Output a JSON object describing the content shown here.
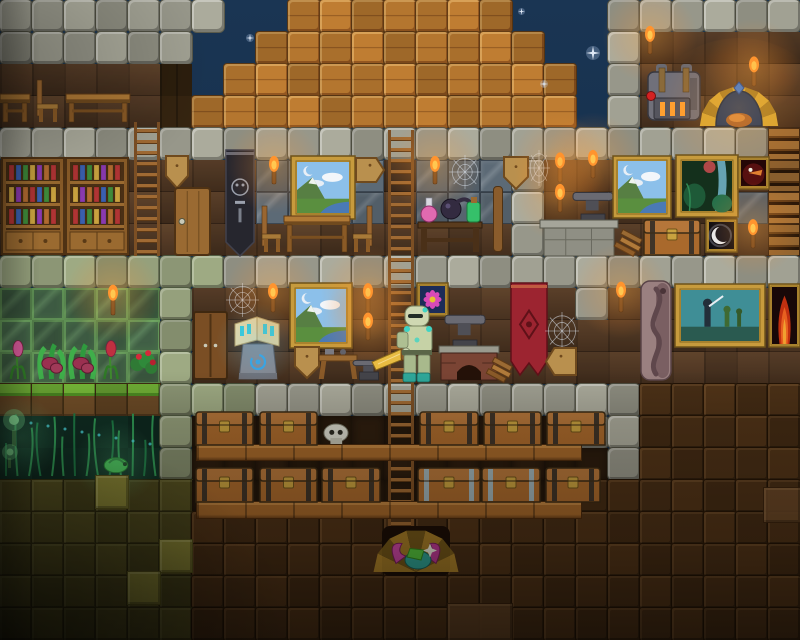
{
  "meta": {
    "scene": "terraria-style-sandbox-house-night",
    "width": 800,
    "height": 640,
    "tile_size": 32
  },
  "palette": {
    "sky_top": "#1a3553",
    "sky_bottom": "#101f35",
    "star": "#dfe8f5",
    "stone": "#a1a193",
    "mossy_stone": "#95a07c",
    "wood_block": "#b4762f",
    "plank_wall": "#503723",
    "glass_wall": "#57646f",
    "greenhouse_glass": "#3d5a42",
    "dirt_block": "#4c3117",
    "dirt_wall": "#2b1c0e",
    "mud": "#514d20",
    "mud_light": "#8e8b38",
    "jungle_wall": "#0f2f24",
    "grass": "#6fae35",
    "torch_flame": "#ff9a30",
    "gold_frame": "#c79b3d",
    "chest_wood": "#a9692c",
    "iron_trim": "#9fb3b8",
    "banner_red": "#9c2430",
    "banner_black": "#26262e",
    "player_armor": "#c6d2a6",
    "player_accent": "#3fd4c4",
    "sword_gold": "#e8bc42"
  },
  "tilemap": {
    "legend": {
      "S": "stone-brick",
      "M": "mossy-stone",
      "W": "wood-beam-block",
      "w": "plank-wall",
      "v": "dark-plank-wall",
      "G": "glass-wall",
      "g": "greenhouse-glass",
      "K": "sky",
      "d": "dirt-wall",
      "D": "dirt-block",
      "J": "jungle-wall",
      "m": "mud-block",
      "L": "grass-block",
      "R": "platform-shelf"
    },
    "solid": [
      "S",
      "M",
      "W",
      "D",
      "m",
      "L",
      "R"
    ],
    "rows": [
      "SSSSSSSKKWWWWWWWKKKSSSSSS",
      "SSSSSSKKWWWWWWWWWKKSwwwww",
      "wwwwwvKWWWWWWWWWWWKSwwwww",
      "wwwwwvWWWWWWWWWWWWKSwwwww",
      "SSSSSSSSSSSSSSSSSSSSSSSSR",
      "wwwwwwwwGGGGwGGGSwwwwwwwR",
      "wwwwwwwwGGGGwGGGSwwwwwwGR",
      "wwwwwwwwwwwwwwwwSwwwwwwwR",
      "MMMMMMMSSSSSSSSSSSSSSSSSS",
      "gggggMwwwwwwwwwwwwSwwwwww",
      "gggggMwwwwwwwwwwwwwwwwwww",
      "gggggMwwwwwwwwwwwwwwwwwww",
      "LLLLLMMMSSSSSSSSSSSSDDDDD",
      "JJJJJMddddddddddddSSDDDDD",
      "JJJJJMdddddddddddddSDDDDD",
      "mmmmmmddddddddddddDDDDDDD",
      "mmmmmmDDDDDDDDDDDDDDDDDDD",
      "mmmmmmDDDDDDDDDDDDDDDDDDD",
      "mmmmmmDDDDDDDDDDDDDDDDDDD",
      "mmmmmmDDDDDDDDDDDDDDDDDDD"
    ]
  },
  "entities": [
    {
      "name": "star-1",
      "type": "star",
      "x": 586,
      "y": 46,
      "w": 14,
      "h": 14,
      "i": false
    },
    {
      "name": "star-2",
      "type": "star",
      "x": 246,
      "y": 34,
      "w": 8,
      "h": 8,
      "i": false
    },
    {
      "name": "star-3",
      "type": "star",
      "x": 540,
      "y": 80,
      "w": 8,
      "h": 8,
      "i": false
    },
    {
      "name": "star-4",
      "type": "star",
      "x": 518,
      "y": 8,
      "w": 7,
      "h": 7,
      "i": false
    },
    {
      "name": "tavern-table-small",
      "type": "table",
      "x": 0,
      "y": 94,
      "w": 30,
      "h": 28,
      "i": true
    },
    {
      "name": "tavern-chair",
      "type": "chair",
      "x": 36,
      "y": 80,
      "w": 24,
      "h": 42,
      "i": true
    },
    {
      "name": "tavern-table",
      "type": "table",
      "x": 66,
      "y": 94,
      "w": 64,
      "h": 28,
      "i": true
    },
    {
      "name": "attic-torch",
      "type": "torch",
      "x": 642,
      "y": 26,
      "w": 16,
      "h": 28,
      "i": false
    },
    {
      "name": "wall-torch-right",
      "type": "torch",
      "x": 746,
      "y": 56,
      "w": 16,
      "h": 30,
      "i": false
    },
    {
      "name": "extractinator-machine",
      "type": "machine",
      "x": 646,
      "y": 64,
      "w": 56,
      "h": 60,
      "i": true
    },
    {
      "name": "hearth-food-shrine",
      "type": "foodshrine",
      "x": 710,
      "y": 86,
      "w": 58,
      "h": 40,
      "i": true
    },
    {
      "name": "ladder-left",
      "type": "ladder",
      "x": 134,
      "y": 122,
      "w": 26,
      "h": 134,
      "i": true
    },
    {
      "name": "ladder-main",
      "type": "ladder",
      "x": 388,
      "y": 130,
      "w": 26,
      "h": 402,
      "i": true
    },
    {
      "name": "bookshelf-left",
      "type": "bookshelf",
      "x": 2,
      "y": 158,
      "w": 62,
      "h": 96,
      "i": true
    },
    {
      "name": "bookshelf-right",
      "type": "bookshelf",
      "x": 66,
      "y": 158,
      "w": 62,
      "h": 96,
      "i": true
    },
    {
      "name": "sign-pennant-library",
      "type": "sign",
      "variant": "pennant",
      "x": 166,
      "y": 156,
      "w": 22,
      "h": 32,
      "i": true
    },
    {
      "name": "wooden-door",
      "type": "door",
      "x": 175,
      "y": 188,
      "w": 35,
      "h": 67,
      "i": true
    },
    {
      "name": "black-banner",
      "type": "banner",
      "variant": "black",
      "x": 226,
      "y": 150,
      "w": 28,
      "h": 106,
      "i": false
    },
    {
      "name": "torch-f2-1",
      "type": "torch",
      "x": 266,
      "y": 156,
      "w": 16,
      "h": 28,
      "i": false
    },
    {
      "name": "painting-mountain-f2",
      "type": "painting",
      "variant": "mountain",
      "x": 291,
      "y": 156,
      "w": 64,
      "h": 63,
      "i": false
    },
    {
      "name": "sign-arrow-right",
      "type": "sign",
      "variant": "arrowr",
      "x": 356,
      "y": 158,
      "w": 28,
      "h": 24,
      "i": true
    },
    {
      "name": "dining-chair-left",
      "type": "chair",
      "x": 261,
      "y": 206,
      "w": 22,
      "h": 46,
      "i": true
    },
    {
      "name": "dining-table",
      "type": "table",
      "x": 284,
      "y": 216,
      "w": 66,
      "h": 36,
      "i": true
    },
    {
      "name": "dining-chair-right",
      "type": "chair",
      "variant": "flip",
      "x": 351,
      "y": 206,
      "w": 22,
      "h": 46,
      "i": true
    },
    {
      "name": "torch-f2-2",
      "type": "torch",
      "x": 427,
      "y": 156,
      "w": 16,
      "h": 28,
      "i": false
    },
    {
      "name": "spider-web-f2",
      "type": "web",
      "x": 449,
      "y": 155,
      "w": 32,
      "h": 34,
      "i": false
    },
    {
      "name": "alchemy-table",
      "type": "potiontable",
      "x": 417,
      "y": 188,
      "w": 66,
      "h": 64,
      "i": true
    },
    {
      "name": "wood-beam-pole",
      "type": "pole",
      "x": 493,
      "y": 186,
      "w": 10,
      "h": 66,
      "i": false
    },
    {
      "name": "sign-pennant-2",
      "type": "sign",
      "variant": "pennant",
      "x": 504,
      "y": 157,
      "w": 24,
      "h": 32,
      "i": true
    },
    {
      "name": "spider-web-corner",
      "type": "web",
      "x": 528,
      "y": 150,
      "w": 22,
      "h": 36,
      "i": false
    },
    {
      "name": "torch-forge-1",
      "type": "torch",
      "x": 552,
      "y": 152,
      "w": 16,
      "h": 30,
      "i": false
    },
    {
      "name": "torch-forge-2",
      "type": "torch",
      "x": 585,
      "y": 150,
      "w": 16,
      "h": 28,
      "i": false
    },
    {
      "name": "torch-forge-3",
      "type": "torch",
      "x": 552,
      "y": 184,
      "w": 16,
      "h": 28,
      "i": false
    },
    {
      "name": "anvil-f2",
      "type": "anvil",
      "x": 573,
      "y": 186,
      "w": 40,
      "h": 36,
      "i": true
    },
    {
      "name": "stone-hearth",
      "type": "hearth",
      "x": 540,
      "y": 220,
      "w": 78,
      "h": 36,
      "i": false
    },
    {
      "name": "wood-debris",
      "type": "debris",
      "x": 619,
      "y": 226,
      "w": 24,
      "h": 28,
      "i": false
    },
    {
      "name": "storage-chest-f2",
      "type": "chest",
      "variant": "wood",
      "x": 644,
      "y": 220,
      "w": 56,
      "h": 35,
      "i": true
    },
    {
      "name": "painting-mountain-2",
      "type": "painting",
      "variant": "mountain",
      "x": 613,
      "y": 156,
      "w": 58,
      "h": 62,
      "i": false
    },
    {
      "name": "painting-jungle",
      "type": "painting",
      "variant": "jungle",
      "x": 676,
      "y": 155,
      "w": 62,
      "h": 62,
      "i": false
    },
    {
      "name": "painting-demon",
      "type": "painting",
      "variant": "demon",
      "x": 738,
      "y": 157,
      "w": 31,
      "h": 32,
      "i": false
    },
    {
      "name": "painting-moon",
      "type": "painting",
      "variant": "moon",
      "x": 706,
      "y": 219,
      "w": 31,
      "h": 33,
      "i": false
    },
    {
      "name": "torch-moon",
      "type": "torch",
      "x": 745,
      "y": 219,
      "w": 16,
      "h": 29,
      "i": false
    },
    {
      "name": "greenhouse-torch",
      "type": "torch",
      "x": 105,
      "y": 284,
      "w": 16,
      "h": 31,
      "i": false
    },
    {
      "name": "plant-tulip-1",
      "type": "plant",
      "variant": "tulip",
      "x": 6,
      "y": 342,
      "w": 24,
      "h": 37,
      "i": false
    },
    {
      "name": "plant-venus-1",
      "type": "plant",
      "variant": "venus",
      "x": 35,
      "y": 340,
      "w": 33,
      "h": 39,
      "i": false
    },
    {
      "name": "plant-venus-2",
      "type": "plant",
      "variant": "venus",
      "x": 66,
      "y": 340,
      "w": 33,
      "h": 39,
      "i": false
    },
    {
      "name": "plant-tulip-2",
      "type": "plant",
      "variant": "tulip2",
      "x": 100,
      "y": 342,
      "w": 22,
      "h": 37,
      "i": false
    },
    {
      "name": "plant-roses",
      "type": "plant",
      "variant": "rose",
      "x": 128,
      "y": 342,
      "w": 31,
      "h": 37,
      "i": false
    },
    {
      "name": "wooden-wardrobe",
      "type": "wardrobe",
      "x": 194,
      "y": 312,
      "w": 33,
      "h": 67,
      "i": true
    },
    {
      "name": "spider-web-f3",
      "type": "web",
      "x": 226,
      "y": 283,
      "w": 33,
      "h": 34,
      "i": false
    },
    {
      "name": "spell-book-altar",
      "type": "bookaltar",
      "x": 233,
      "y": 308,
      "w": 48,
      "h": 71,
      "i": true
    },
    {
      "name": "torch-f3-1",
      "type": "torch",
      "x": 265,
      "y": 283,
      "w": 16,
      "h": 29,
      "i": false
    },
    {
      "name": "painting-mountain-3",
      "type": "painting",
      "variant": "mountain",
      "x": 290,
      "y": 283,
      "w": 62,
      "h": 65,
      "i": false
    },
    {
      "name": "torch-f3-2",
      "type": "torch",
      "x": 360,
      "y": 283,
      "w": 16,
      "h": 29,
      "i": false
    },
    {
      "name": "torch-f3-3",
      "type": "torch",
      "x": 360,
      "y": 313,
      "w": 16,
      "h": 27,
      "i": false
    },
    {
      "name": "sign-shield",
      "type": "sign",
      "variant": "pennant",
      "x": 295,
      "y": 347,
      "w": 24,
      "h": 31,
      "i": true
    },
    {
      "name": "work-bench",
      "type": "workbench",
      "x": 319,
      "y": 349,
      "w": 38,
      "h": 30,
      "i": true
    },
    {
      "name": "anvil-small",
      "type": "anvil",
      "x": 353,
      "y": 356,
      "w": 32,
      "h": 24,
      "i": true
    },
    {
      "name": "painting-flower",
      "type": "painting",
      "variant": "flower",
      "x": 417,
      "y": 283,
      "w": 31,
      "h": 33,
      "i": false
    },
    {
      "name": "anvil-large",
      "type": "anvil",
      "x": 445,
      "y": 308,
      "w": 40,
      "h": 40,
      "i": true
    },
    {
      "name": "brick-hearth",
      "type": "hearthbrick",
      "x": 439,
      "y": 346,
      "w": 60,
      "h": 34,
      "i": false
    },
    {
      "name": "wood-slope",
      "type": "debris",
      "x": 491,
      "y": 354,
      "w": 22,
      "h": 26,
      "i": false
    },
    {
      "name": "red-banner",
      "type": "banner",
      "variant": "red",
      "x": 511,
      "y": 283,
      "w": 36,
      "h": 92,
      "i": false
    },
    {
      "name": "spider-web-f3-2",
      "type": "web",
      "x": 545,
      "y": 312,
      "w": 34,
      "h": 38,
      "i": false
    },
    {
      "name": "sign-arrow-left",
      "type": "sign",
      "variant": "arrowl",
      "x": 546,
      "y": 348,
      "w": 30,
      "h": 27,
      "i": true
    },
    {
      "name": "torch-f3-4",
      "type": "torch",
      "x": 612,
      "y": 281,
      "w": 18,
      "h": 31,
      "i": false
    },
    {
      "name": "carved-pillar",
      "type": "pillar",
      "x": 640,
      "y": 281,
      "w": 32,
      "h": 99,
      "i": false
    },
    {
      "name": "painting-battle",
      "type": "painting",
      "variant": "battle",
      "x": 675,
      "y": 284,
      "w": 90,
      "h": 63,
      "i": false
    },
    {
      "name": "painting-fire",
      "type": "painting",
      "variant": "fire",
      "x": 769,
      "y": 284,
      "w": 31,
      "h": 63,
      "i": false
    },
    {
      "name": "floor-plank-upper",
      "type": "floor",
      "x": 196,
      "y": 444,
      "w": 386,
      "h": 17,
      "i": false
    },
    {
      "name": "floor-plank-lower",
      "type": "floor",
      "x": 196,
      "y": 501,
      "w": 386,
      "h": 18,
      "i": false
    },
    {
      "name": "chest-r1-1",
      "type": "chest",
      "variant": "wood",
      "x": 196,
      "y": 412,
      "w": 57,
      "h": 33,
      "i": true
    },
    {
      "name": "chest-r1-2",
      "type": "chest",
      "variant": "wood",
      "x": 260,
      "y": 412,
      "w": 57,
      "h": 33,
      "i": true
    },
    {
      "name": "skull-item",
      "type": "skull",
      "x": 322,
      "y": 424,
      "w": 28,
      "h": 20,
      "i": false
    },
    {
      "name": "chest-r1-3",
      "type": "chest",
      "variant": "wood",
      "x": 420,
      "y": 412,
      "w": 58,
      "h": 33,
      "i": true
    },
    {
      "name": "chest-r1-4",
      "type": "chest",
      "variant": "wood",
      "x": 484,
      "y": 412,
      "w": 57,
      "h": 33,
      "i": true
    },
    {
      "name": "chest-r1-5",
      "type": "chest",
      "variant": "wood",
      "x": 547,
      "y": 412,
      "w": 58,
      "h": 33,
      "i": true
    },
    {
      "name": "chest-r2-1",
      "type": "chest",
      "variant": "wood",
      "x": 196,
      "y": 468,
      "w": 57,
      "h": 34,
      "i": true
    },
    {
      "name": "chest-r2-2",
      "type": "chest",
      "variant": "wood",
      "x": 260,
      "y": 468,
      "w": 57,
      "h": 34,
      "i": true
    },
    {
      "name": "chest-r2-3",
      "type": "chest",
      "variant": "wood",
      "x": 322,
      "y": 468,
      "w": 58,
      "h": 34,
      "i": true
    },
    {
      "name": "chest-r2-4",
      "type": "chest",
      "variant": "iron",
      "x": 418,
      "y": 468,
      "w": 62,
      "h": 34,
      "i": true
    },
    {
      "name": "chest-r2-5",
      "type": "chest",
      "variant": "iron",
      "x": 482,
      "y": 468,
      "w": 58,
      "h": 34,
      "i": true
    },
    {
      "name": "chest-r2-6",
      "type": "chest",
      "variant": "wood",
      "x": 546,
      "y": 468,
      "w": 54,
      "h": 34,
      "i": true
    },
    {
      "name": "treasure-shrine",
      "type": "treasure",
      "x": 382,
      "y": 526,
      "w": 68,
      "h": 50,
      "i": true
    },
    {
      "name": "jungle-overgrowth",
      "type": "flora",
      "x": 0,
      "y": 410,
      "w": 164,
      "h": 66,
      "i": false
    },
    {
      "name": "glowing-puffs",
      "type": "puff",
      "x": 0,
      "y": 406,
      "w": 40,
      "h": 64,
      "i": false
    },
    {
      "name": "glowing-critter",
      "type": "critter",
      "x": 102,
      "y": 452,
      "w": 28,
      "h": 22,
      "i": false
    },
    {
      "name": "mud-light-1",
      "type": "mudlight",
      "x": 96,
      "y": 476,
      "w": 32,
      "h": 32,
      "i": true
    },
    {
      "name": "mud-light-2",
      "type": "mudlight",
      "x": 160,
      "y": 540,
      "w": 32,
      "h": 32,
      "i": true
    },
    {
      "name": "mud-light-3",
      "type": "mudlight",
      "x": 128,
      "y": 572,
      "w": 32,
      "h": 32,
      "i": true
    },
    {
      "name": "dirt-light-1",
      "type": "dirtlight",
      "x": 448,
      "y": 604,
      "w": 64,
      "h": 36,
      "i": true
    },
    {
      "name": "dirt-light-2",
      "type": "dirtlight",
      "x": 764,
      "y": 488,
      "w": 36,
      "h": 34,
      "i": true
    },
    {
      "name": "player-character",
      "type": "player",
      "x": 370,
      "y": 306,
      "w": 64,
      "h": 78,
      "i": true
    }
  ]
}
